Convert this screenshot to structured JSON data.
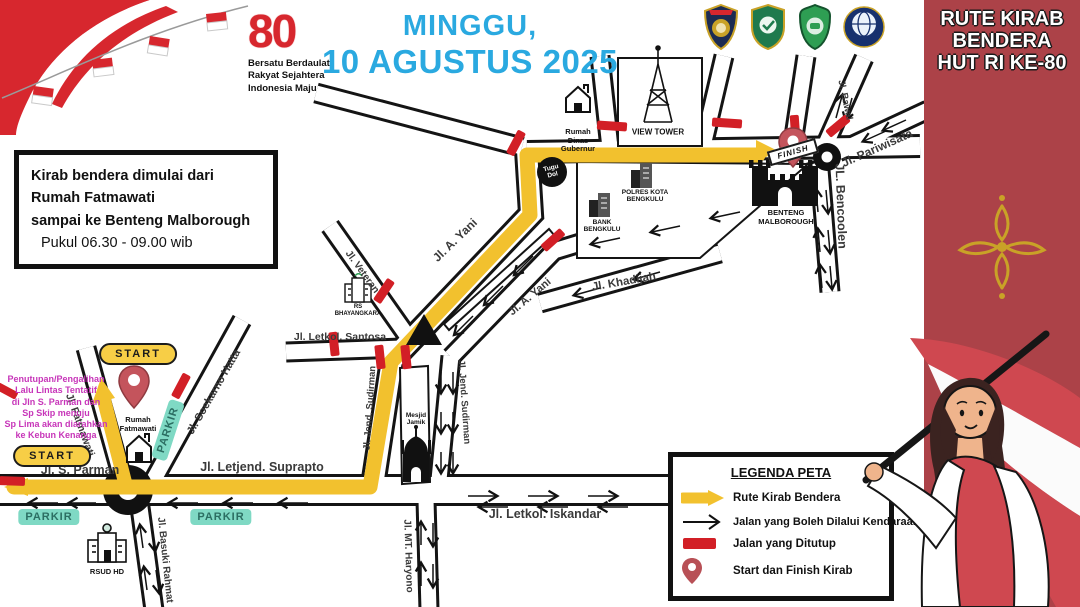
{
  "header": {
    "title_line1": "MINGGU,",
    "title_line2": "10 AGUSTUS 2025",
    "title_color": "#2AA9E0",
    "logo_80": {
      "number": "80",
      "tagline_line1": "Bersatu Berdaulat",
      "tagline_line2": "Rakyat Sejahtera",
      "tagline_line3": "Indonesia Maju"
    },
    "crests": [
      "polri-shield-crest",
      "provinsi-bengkulu-crest",
      "kota-bengkulu-crest",
      "kemenhub-globe-crest"
    ]
  },
  "sidebar": {
    "title_line1": "RUTE KIRAB",
    "title_line2": "BENDERA",
    "title_line3": "HUT RI KE-80",
    "bg_color": "#AC4248",
    "ornament_color": "#C9A227"
  },
  "info_box": {
    "line1": "Kirab bendera dimulai dari",
    "line2": "Rumah Fatmawati",
    "line3": "sampai ke Benteng Malborough",
    "line4": "Pukul 06.30 - 09.00 wib"
  },
  "notice": {
    "color": "#C735B9",
    "line1": "Penutupan/Pengalihan",
    "line2": "Lalu Lintas Tentatif",
    "line3": "di Jln S. Parman dan",
    "line4": "Sp Skip menuju",
    "line5": "Sp Lima akan diarahkan",
    "line6": "ke Kebun Kenanga"
  },
  "legend": {
    "title": "LEGENDA PETA",
    "item1": "Rute Kirab Bendera",
    "item2": "Jalan yang Boleh Dilalui Kendaraan",
    "item3": "Jalan yang Ditutup",
    "item4": "Start dan Finish Kirab"
  },
  "map": {
    "route_color": "#F2C12E",
    "closed_color": "#D21F26",
    "parkir_color": "#7FD9C4",
    "labels": {
      "s_parman": "Jl. S. Parman",
      "suprapto": "Jl. Letjend. Suprapto",
      "iskandar": "Jl. Letkol. Iskandar",
      "mt_haryono": "Jl. MT. Haryono",
      "basuki_rahmat": "Jl. Basuki Rahmat",
      "fatmawati": "Jl. Fatmawati",
      "soekarno_hatta": "Jl. Soekarno Hatta",
      "sudirman_left": "Jl. Jend. Sudirman",
      "sudirman_right": "Jl. Jend. Sudirman",
      "a_yani_route": "Jl. A. Yani",
      "a_yani_lower": "Jl. A. Yani",
      "veteran": "Jl. Veteran",
      "santosa": "Jl. Letkol. Santosa",
      "khadijah": "Jl. Khadijah",
      "bencoolen": "JL. Bencoolen",
      "pariwisata": "Jl. Pariwisata",
      "bawal": "Jl. Bawal"
    },
    "badges": {
      "start": "START",
      "finish": "FINISH",
      "parkir": "PARKIR"
    },
    "pois": {
      "rumah_fatmawati_line1": "Rumah",
      "rumah_fatmawati_line2": "Fatmawati",
      "benteng_line1": "BENTENG",
      "benteng_line2": "MALBOROUGH",
      "view_tower": "VIEW TOWER",
      "rumah_dinas_line1": "Rumah",
      "rumah_dinas_line2": "Dinas",
      "rumah_dinas_line3": "Gubernur",
      "tugu_line1": "Tugu",
      "tugu_line2": "Dol",
      "polres_line1": "POLRES KOTA",
      "polres_line2": "BENGKULU",
      "bank_line1": "BANK",
      "bank_line2": "BENGKULU",
      "mesjid_line1": "Mesjid",
      "mesjid_line2": "Jamik",
      "rsud": "RSUD HD",
      "bhayangkara_line1": "RS",
      "bhayangkara_line2": "BHAYANGKARA"
    }
  }
}
